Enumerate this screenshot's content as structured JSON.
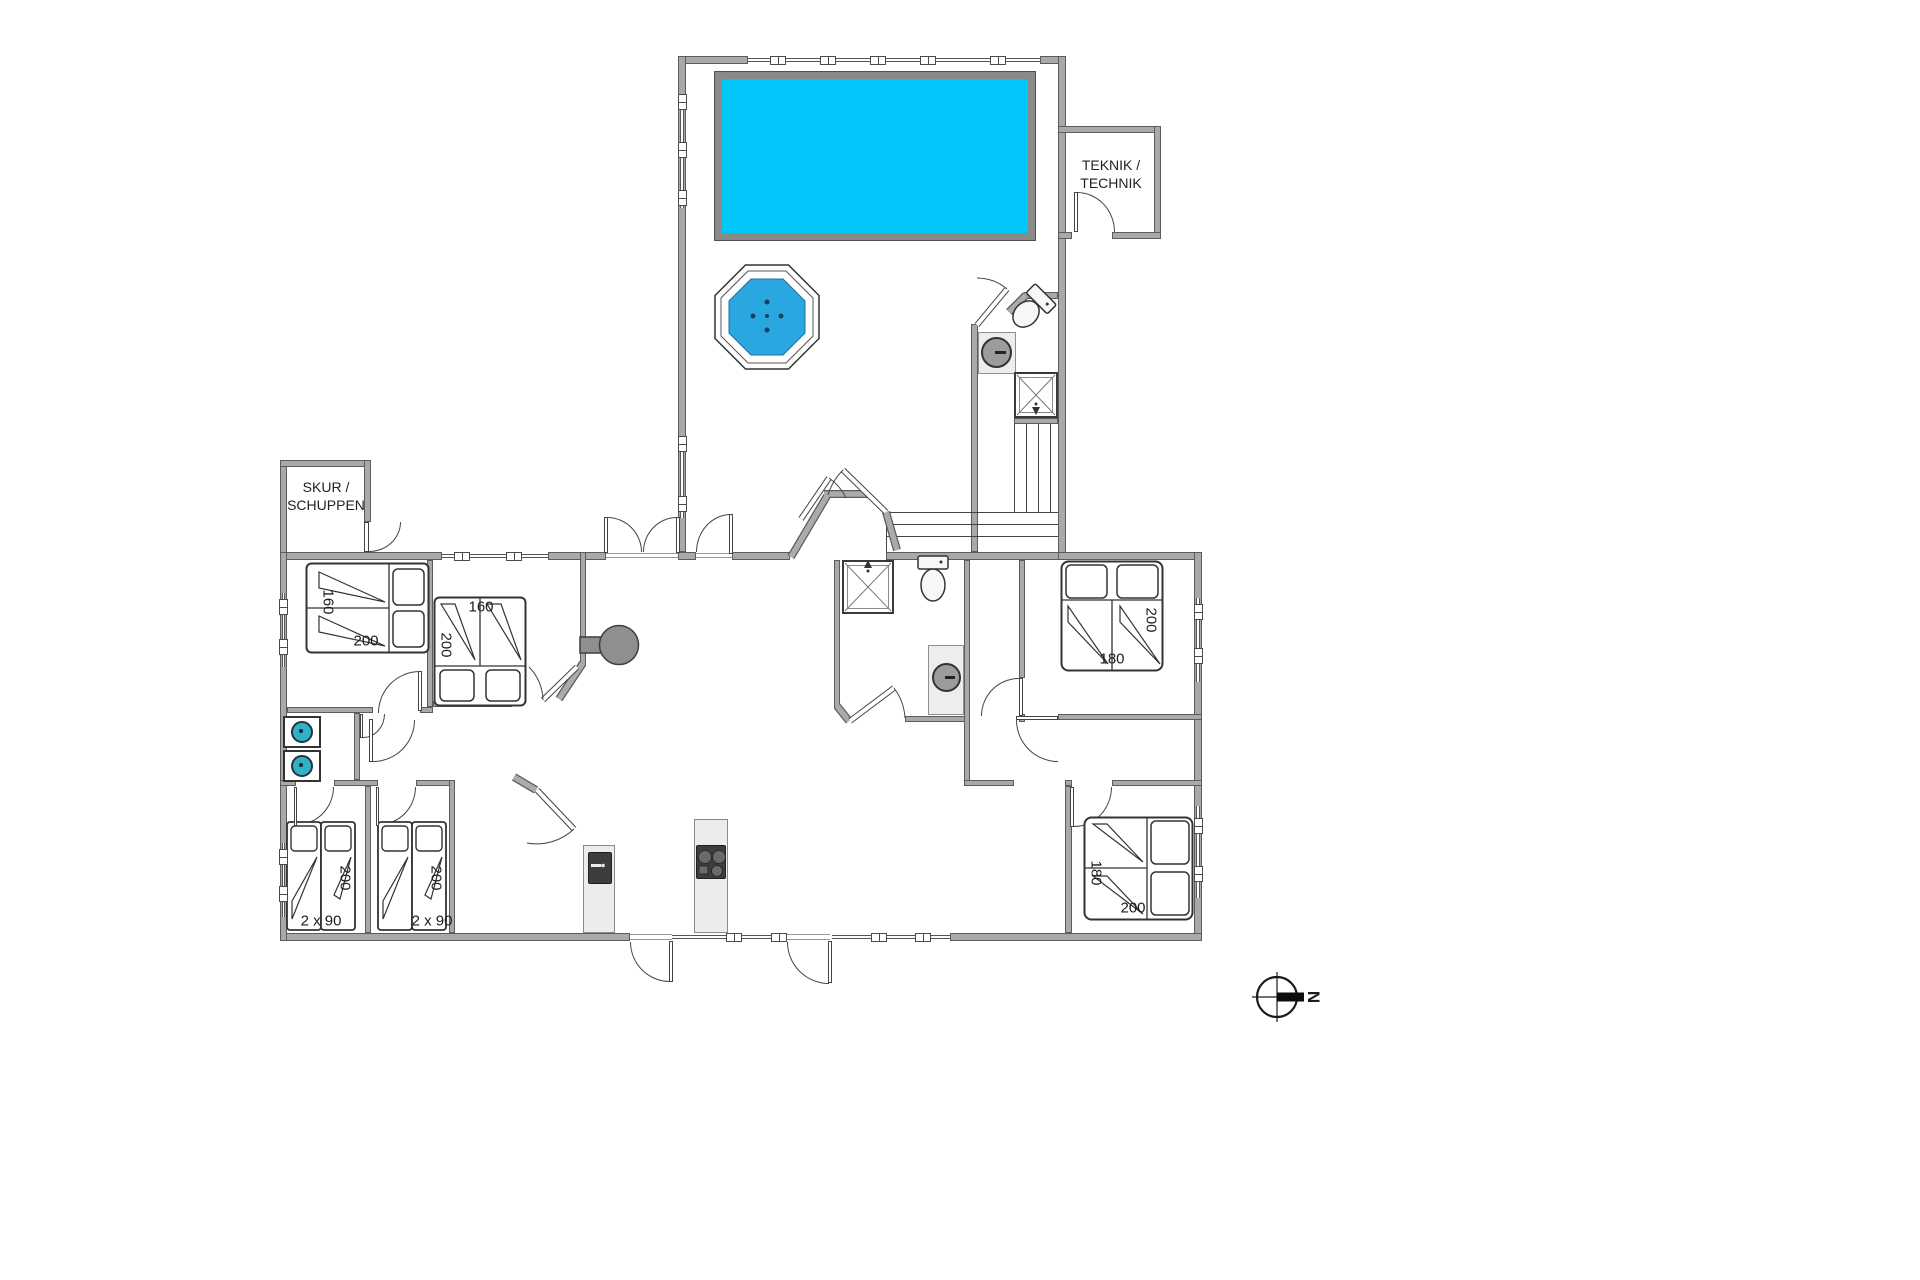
{
  "labels": {
    "teknik": [
      "TEKNIK /",
      "TECHNIK"
    ],
    "shed": [
      "SKUR /",
      "SCHUPPEN"
    ],
    "compass_north": "N"
  },
  "beds": {
    "bedroom_1": {
      "width": "160",
      "length": "200"
    },
    "bedroom_2": {
      "width": "160",
      "length": "200"
    },
    "bedroom_3": {
      "width": "2 x 90",
      "length": "200"
    },
    "bedroom_4": {
      "width": "2 x 90",
      "length": "200"
    },
    "bedroom_5": {
      "width": "180",
      "length": "200"
    },
    "bedroom_6": {
      "width": "180",
      "length": "200"
    }
  },
  "colors": {
    "pool_water": "#00c6f9",
    "hot_tub_water": "#2aa7e0",
    "wall": "#a9a9a9",
    "washer_accent": "#2fb3c4"
  }
}
